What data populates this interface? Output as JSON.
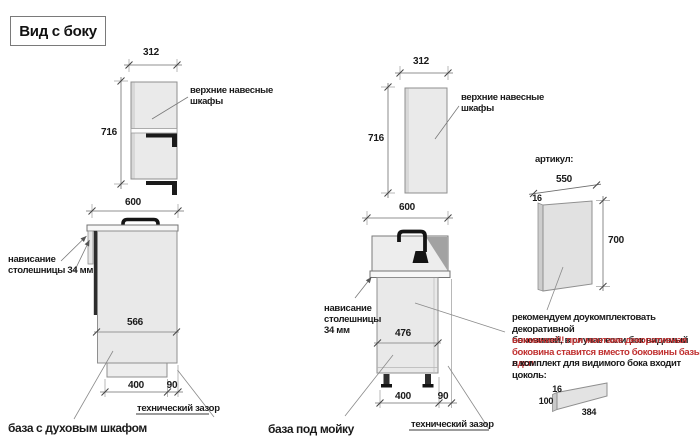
{
  "title": "Вид с боку",
  "upper_cabinet_left": {
    "label": "верхние навесные\nшкафы",
    "dim_width": "312",
    "dim_height": "716"
  },
  "base_oven": {
    "dim_width": "600",
    "dim_depth": "566",
    "dim_plinth": "400",
    "dim_gap": "90",
    "overhang_label": "нависание\nстолешницы 34 мм",
    "tech_gap_label": "технический зазор",
    "caption": "база с духовым шкафом"
  },
  "upper_cabinet_mid": {
    "label": "верхние навесные\nшкафы",
    "dim_width": "312",
    "dim_height": "716"
  },
  "base_sink": {
    "dim_width": "600",
    "dim_depth": "476",
    "dim_plinth": "400",
    "dim_gap": "90",
    "overhang_label": "нависание\nстолешницы\n34 мм",
    "tech_gap_label": "технический зазор",
    "caption": "база под мойку"
  },
  "side_panel": {
    "heading": "артикул:",
    "dim_width": "550",
    "dim_thickness": "16",
    "dim_height": "700"
  },
  "note": {
    "black_1": "рекомендуем доукомплектовать декоративной\nбоковиной, в случае если бок видимый",
    "red_warning": "внимание!!! при монтаже декоративная\nбоковина ставится вместо боковины базы лдсп",
    "black_2": "в комплект для видимого бока входит цоколь:"
  },
  "plinth": {
    "dim_thickness": "16",
    "dim_height": "100",
    "dim_length": "384"
  },
  "colors": {
    "warning_red": "#c03030",
    "cabinet_fill": "#e9e9e9",
    "drawing_line": "#8f8f8f",
    "dark_parts": "#1c1c1c"
  }
}
